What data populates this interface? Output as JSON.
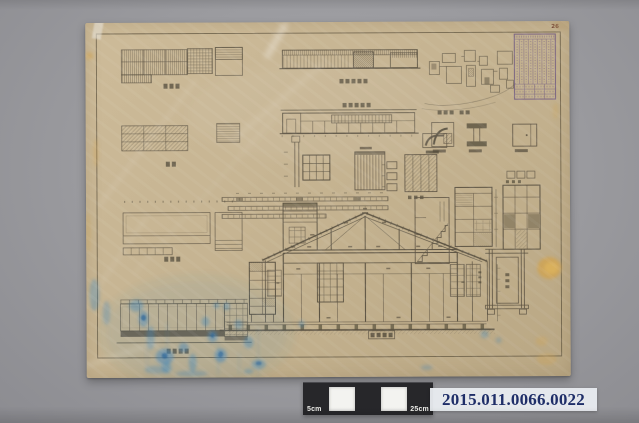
{
  "photo": {
    "type": "archival photograph of an architectural drawing sheet",
    "background_color": "#9a9a9e"
  },
  "sheet": {
    "page_number": "26",
    "paper_color": "#c7b593",
    "ink_color": "#4a4336",
    "stamp_color": "#6a5480",
    "blue_stain_color": "#3f86bb",
    "yellow_stain_color": "#cfa24f"
  },
  "scale_bar": {
    "left_label": "5cm",
    "right_label": "25cm",
    "dark_color": "#27272a",
    "light_color": "#f3f3f0"
  },
  "accession": {
    "number": "2015.011.0066.0022",
    "text_color": "#1f2e68",
    "background_color": "#e9ecf0"
  }
}
